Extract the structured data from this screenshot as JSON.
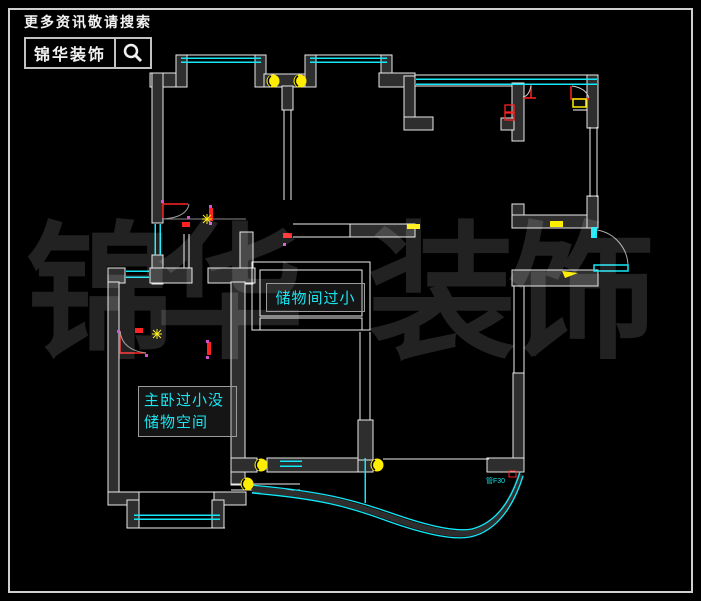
{
  "page": {
    "background": "#000000",
    "frame_color": "#cfcfcf"
  },
  "logo": {
    "tagline": "更多资讯敬请搜索",
    "brand": "锦华装饰",
    "icon": "magnifier-icon"
  },
  "watermark": {
    "char1": "锦",
    "char2": "华",
    "char3": "装",
    "char4": "饰",
    "color": "#222222"
  },
  "annotations": {
    "storage_note": "储物间过小",
    "master_note_line1": "主卧过小没",
    "master_note_line2": "储物空间",
    "pipe_label": "管F30",
    "text_color": "#19e6f2"
  },
  "legend_colors": {
    "wall_fill": "#2e2e2e",
    "wall_outline": "#ededed",
    "window_cyan": "#12e8f8",
    "symbol_yellow": "#ffee00",
    "door_red": "#ff2222",
    "marker_magenta": "#d352d3"
  }
}
